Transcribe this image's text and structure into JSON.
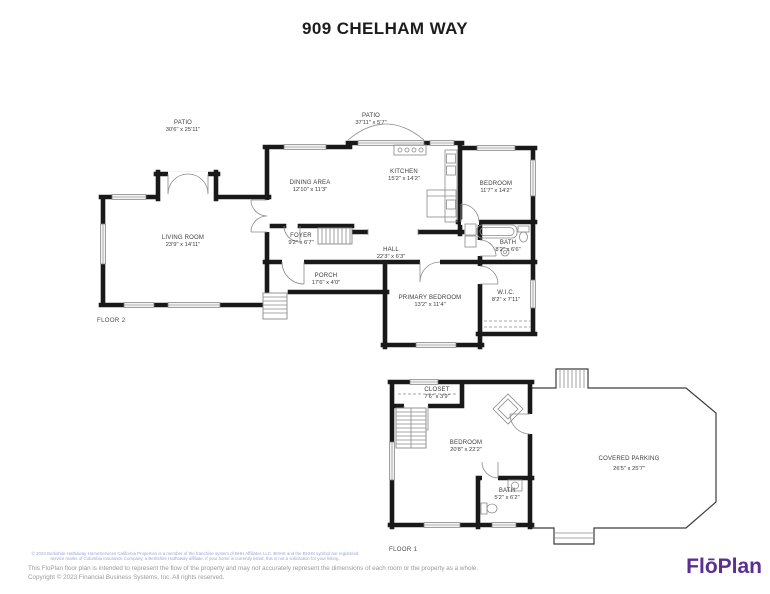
{
  "title": "909 CHELHAM WAY",
  "floor2": {
    "label": "FLOOR 2",
    "rooms": {
      "patio_left": {
        "name": "PATIO",
        "dims": "30'6\" x 25'11\""
      },
      "patio_top": {
        "name": "PATIO",
        "dims": "37'11\" x 5'7\""
      },
      "dining": {
        "name": "DINING AREA",
        "dims": "12'10\" x 11'3\""
      },
      "kitchen": {
        "name": "KITCHEN",
        "dims": "15'2\" x 14'2\""
      },
      "bedroom": {
        "name": "BEDROOM",
        "dims": "11'7\" x 14'2\""
      },
      "living": {
        "name": "LIVING ROOM",
        "dims": "23'9\" x 14'11\""
      },
      "foyer": {
        "name": "FOYER",
        "dims": "9'2\" x 6'7\""
      },
      "hall": {
        "name": "HALL",
        "dims": "22'3\" x 6'3\""
      },
      "bath": {
        "name": "BATH",
        "dims": "8'2\" x 6'6\""
      },
      "porch": {
        "name": "PORCH",
        "dims": "17'6\" x 4'0\""
      },
      "primary_bedroom": {
        "name": "PRIMARY BEDROOM",
        "dims": "13'2\" x 11'4\""
      },
      "wic": {
        "name": "W.I.C.",
        "dims": "8'2\" x 7'11\""
      }
    }
  },
  "floor1": {
    "label": "FLOOR 1",
    "rooms": {
      "closet": {
        "name": "CLOSET",
        "dims": "7'6\" x 3'9\""
      },
      "bedroom": {
        "name": "BEDROOM",
        "dims": "20'8\" x 22'2\""
      },
      "bath": {
        "name": "BATH",
        "dims": "5'2\" x 6'2\""
      },
      "covered_parking": {
        "name": "COVERED PARKING",
        "dims": "26'5\" x 25'7\""
      }
    }
  },
  "footer": {
    "disclaimer_brokerage": "© 2023 Berkshire Hathaway HomeServices California Properties is a member of the franchise system of BHH Affiliates LLC.  BHHS and the BHHS symbol are registered service marks of Columbia Insurance Company, a Berkshire Hathaway affiliate.  If your home is currently listed, this is not a solicitation for your listing.",
    "disclaimer_floplan": "This FloPlan floor plan is intended to represent the flow of the property and may not accurately represent the dimensions of each room or the property as a whole.",
    "copyright": "Copyright © 2023 Financial Business Systems, Inc. All rights reserved.",
    "logo": "FlōPlan"
  },
  "colors": {
    "wall": "#191919",
    "thin_line": "#8b8b8b",
    "label_text": "#3c3c3c",
    "logo_purple": "#5b2e91",
    "disclaimer_blue": "#98a6d8",
    "footer_gray": "#9a9a9a"
  }
}
